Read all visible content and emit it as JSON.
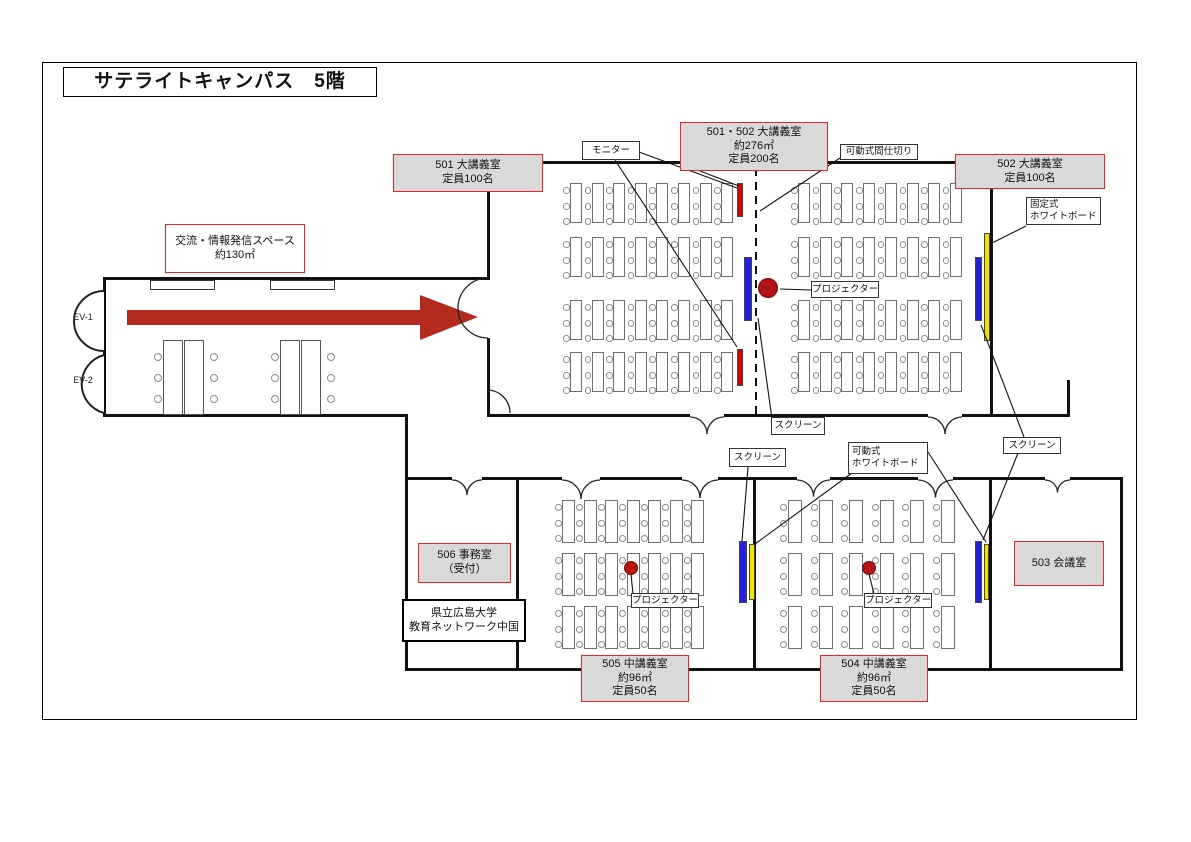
{
  "floorplan": {
    "colors": {
      "wall": "#111111",
      "label_red_border": "#f02121",
      "label_gray_fill": "#d9d9d9",
      "monitor": "#dd0000",
      "screen": "#2020dd",
      "whiteboard": "#f2e200",
      "projector": "#b41414",
      "arrow": "#b22b1e"
    },
    "frame": {
      "x": 42,
      "y": 62,
      "w": 1095,
      "h": 658
    },
    "labels": [
      {
        "name": "page-title",
        "type": "t-title",
        "x": 63,
        "y": 67,
        "w": 314,
        "h": 30,
        "lines": [
          "サテライトキャンパス　5階"
        ]
      },
      {
        "name": "room-label-501-502",
        "type": "t-room",
        "x": 680,
        "y": 122,
        "w": 148,
        "h": 49,
        "lines": [
          "501・502 大講義室",
          "約276㎡",
          "定員200名"
        ]
      },
      {
        "name": "room-label-501",
        "type": "t-room",
        "x": 393,
        "y": 154,
        "w": 150,
        "h": 38,
        "lines": [
          "501 大講義室",
          "定員100名"
        ]
      },
      {
        "name": "room-label-502",
        "type": "t-room",
        "x": 955,
        "y": 154,
        "w": 150,
        "h": 35,
        "lines": [
          "502 大講義室",
          "定員100名"
        ]
      },
      {
        "name": "open-space-label",
        "type": "t-open",
        "x": 165,
        "y": 224,
        "w": 140,
        "h": 49,
        "lines": [
          "交流・情報発信スペース",
          "約130㎡"
        ]
      },
      {
        "name": "room-label-503",
        "type": "t-room",
        "x": 1014,
        "y": 541,
        "w": 90,
        "h": 45,
        "lines": [
          "503 会議室"
        ]
      },
      {
        "name": "room-label-504",
        "type": "t-room",
        "x": 820,
        "y": 655,
        "w": 108,
        "h": 47,
        "lines": [
          "504 中講義室",
          "約96㎡",
          "定員50名"
        ]
      },
      {
        "name": "room-label-505",
        "type": "t-room",
        "x": 581,
        "y": 655,
        "w": 108,
        "h": 47,
        "lines": [
          "505 中講義室",
          "約96㎡",
          "定員50名"
        ]
      },
      {
        "name": "room-label-506",
        "type": "t-room",
        "x": 418,
        "y": 543,
        "w": 93,
        "h": 40,
        "lines": [
          "506 事務室",
          "（受付）"
        ]
      },
      {
        "name": "org-label",
        "type": "t-info",
        "x": 402,
        "y": 599,
        "w": 124,
        "h": 43,
        "lines": [
          "県立広島大学",
          "教育ネットワーク中国"
        ]
      },
      {
        "name": "tag-monitor",
        "type": "t-tag",
        "x": 582,
        "y": 141,
        "w": 58,
        "h": 19,
        "lines": [
          "モニター"
        ]
      },
      {
        "name": "tag-movable-partition",
        "type": "t-tag",
        "x": 840,
        "y": 144,
        "w": 78,
        "h": 16,
        "lines": [
          "可動式間仕切り"
        ]
      },
      {
        "name": "tag-fixed-whiteboard",
        "type": "t-tagL",
        "x": 1026,
        "y": 197,
        "w": 75,
        "h": 28,
        "lines": [
          "固定式",
          "ホワイトボード"
        ]
      },
      {
        "name": "tag-projector-main",
        "type": "t-tag",
        "x": 811,
        "y": 281,
        "w": 68,
        "h": 17,
        "lines": [
          "プロジェクター"
        ]
      },
      {
        "name": "tag-screen-main",
        "type": "t-tag",
        "x": 771,
        "y": 417,
        "w": 54,
        "h": 18,
        "lines": [
          "スクリーン"
        ]
      },
      {
        "name": "tag-screen-505",
        "type": "t-tag",
        "x": 729,
        "y": 448,
        "w": 57,
        "h": 19,
        "lines": [
          "スクリーン"
        ]
      },
      {
        "name": "tag-movable-whiteboard",
        "type": "t-tagL",
        "x": 848,
        "y": 442,
        "w": 80,
        "h": 32,
        "lines": [
          "可動式",
          "ホワイトボード"
        ]
      },
      {
        "name": "tag-screen-right",
        "type": "t-tag",
        "x": 1003,
        "y": 437,
        "w": 58,
        "h": 17,
        "lines": [
          "スクリーン"
        ]
      },
      {
        "name": "tag-projector-505",
        "type": "t-tag",
        "x": 631,
        "y": 593,
        "w": 68,
        "h": 15,
        "lines": [
          "プロジェクター"
        ]
      },
      {
        "name": "tag-projector-504",
        "type": "t-tag",
        "x": 864,
        "y": 593,
        "w": 68,
        "h": 15,
        "lines": [
          "プロジェクター"
        ]
      },
      {
        "name": "ev1-label",
        "type": "t-plain",
        "x": 66,
        "y": 312,
        "w": 34,
        "h": 12,
        "lines": [
          "EV-1"
        ]
      },
      {
        "name": "ev2-label",
        "type": "t-plain",
        "x": 66,
        "y": 375,
        "w": 34,
        "h": 12,
        "lines": [
          "EV-2"
        ]
      }
    ],
    "walls": [
      [
        487,
        161,
        509,
        3
      ],
      [
        487,
        161,
        3,
        117
      ],
      [
        487,
        338,
        3,
        79
      ],
      [
        990,
        164,
        3,
        253
      ],
      [
        487,
        414,
        203,
        3
      ],
      [
        724,
        414,
        204,
        3
      ],
      [
        962,
        414,
        108,
        3
      ],
      [
        1067,
        380,
        3,
        37
      ],
      [
        103,
        277,
        387,
        3
      ],
      [
        103,
        277,
        3,
        140
      ],
      [
        103,
        414,
        305,
        3
      ],
      [
        405,
        414,
        3,
        66
      ],
      [
        405,
        477,
        47,
        3
      ],
      [
        482,
        477,
        80,
        3
      ],
      [
        600,
        477,
        82,
        3
      ],
      [
        718,
        477,
        79,
        3
      ],
      [
        830,
        477,
        88,
        3
      ],
      [
        953,
        477,
        92,
        3
      ],
      [
        1070,
        477,
        53,
        3
      ],
      [
        405,
        477,
        3,
        194
      ],
      [
        516,
        477,
        3,
        194
      ],
      [
        753,
        477,
        3,
        194
      ],
      [
        989,
        477,
        3,
        194
      ],
      [
        1120,
        477,
        3,
        194
      ],
      [
        405,
        668,
        718,
        3
      ]
    ],
    "dashed_partitions": [
      {
        "name": "movable-partition-line",
        "x": 754.5,
        "y": 168,
        "w": 2.5,
        "h": 246
      }
    ],
    "doors_south": [
      {
        "x1": 690,
        "x2": 724,
        "y": 417
      },
      {
        "x1": 928,
        "x2": 962,
        "y": 417
      },
      {
        "x1": 452,
        "x2": 482,
        "y": 480
      },
      {
        "x1": 562,
        "x2": 600,
        "y": 480
      },
      {
        "x1": 682,
        "x2": 718,
        "y": 480
      },
      {
        "x1": 797,
        "x2": 830,
        "y": 480
      },
      {
        "x1": 918,
        "x2": 953,
        "y": 480
      },
      {
        "x1": 1045,
        "x2": 1070,
        "y": 480
      }
    ],
    "doors_west": [
      {
        "x": 488,
        "y1": 278,
        "y2": 338,
        "r": 30
      }
    ],
    "doors_raw": [
      {
        "d": "M 487,390 A 23 23 0 0 1 510,413"
      }
    ],
    "elevators": [
      {
        "name": "elevator-ev1",
        "d": "M 104,291 A 30 30 0 0 0 104,351"
      },
      {
        "name": "elevator-ev2",
        "d": "M 104,355 A 30 30 0 0 0 104,413"
      }
    ],
    "arrow": {
      "points": "127,310 420,310 420,295 478,317 420,340 420,325 127,325"
    },
    "pointer_lines": [
      [
        639,
        152,
        737,
        188
      ],
      [
        615,
        160,
        737,
        347
      ],
      [
        700,
        171,
        739,
        186
      ],
      [
        843,
        156,
        760,
        211
      ],
      [
        811,
        290,
        780,
        289
      ],
      [
        772,
        419,
        758,
        318
      ],
      [
        1026,
        226,
        992,
        243
      ],
      [
        748,
        467,
        742,
        541
      ],
      [
        852,
        473,
        755,
        544
      ],
      [
        928,
        452,
        986,
        542
      ],
      [
        1024,
        437,
        981,
        325
      ],
      [
        1018,
        453,
        983,
        540
      ],
      [
        631,
        574,
        633,
        594
      ],
      [
        869,
        574,
        874,
        594
      ]
    ],
    "desk_groups": [
      {
        "room": "501",
        "x": 570,
        "dx": 21.6,
        "cols": 8,
        "bandYs": [
          183,
          237,
          300,
          352
        ],
        "deskW": 12,
        "deskH": 40,
        "chairXoff": -7,
        "chairYoffs": [
          4,
          20,
          35
        ],
        "chairD": 6.5
      },
      {
        "room": "502",
        "x": 798,
        "dx": 21.7,
        "cols": 8,
        "bandYs": [
          183,
          237,
          300,
          352
        ],
        "deskW": 12,
        "deskH": 40,
        "chairXoff": -7,
        "chairYoffs": [
          4,
          20,
          35
        ],
        "chairD": 6.5
      },
      {
        "room": "505",
        "x": 562,
        "dx": 21.5,
        "cols": 7,
        "bandYs": [
          500,
          553,
          606
        ],
        "deskW": 13,
        "deskH": 43,
        "chairXoff": -7.5,
        "chairYoffs": [
          4,
          20,
          35
        ],
        "chairD": 7
      },
      {
        "room": "504",
        "x": 788,
        "dx": 30.5,
        "cols": 6,
        "bandYs": [
          500,
          553,
          606
        ],
        "deskW": 14,
        "deskH": 43,
        "chairXoff": -8,
        "chairYoffs": [
          4,
          20,
          35
        ],
        "chairD": 7
      }
    ],
    "lobby": {
      "tableW": 20,
      "tableH": 75,
      "tables": [
        [
          163,
          340
        ],
        [
          184,
          340
        ],
        [
          280,
          340
        ],
        [
          301,
          340
        ]
      ],
      "chairD": 8,
      "chairs": [
        [
          154,
          353
        ],
        [
          154,
          374
        ],
        [
          154,
          395
        ],
        [
          210,
          353
        ],
        [
          210,
          374
        ],
        [
          210,
          395
        ],
        [
          271,
          353
        ],
        [
          271,
          374
        ],
        [
          271,
          395
        ],
        [
          327,
          353
        ],
        [
          327,
          374
        ],
        [
          327,
          395
        ]
      ],
      "counters": [
        [
          150,
          280,
          65,
          10
        ],
        [
          270,
          280,
          65,
          10
        ]
      ]
    },
    "equipment": [
      {
        "name": "monitor-bar-top",
        "color": "monitor",
        "x": 737,
        "y": 183,
        "w": 6,
        "h": 34
      },
      {
        "name": "monitor-bar-bottom",
        "color": "monitor",
        "x": 737,
        "y": 349,
        "w": 6,
        "h": 37
      },
      {
        "name": "screen-bar-center",
        "color": "screen",
        "x": 744,
        "y": 257,
        "w": 8,
        "h": 64
      },
      {
        "name": "screen-bar-502-right",
        "color": "screen",
        "x": 975,
        "y": 257,
        "w": 7,
        "h": 64
      },
      {
        "name": "whiteboard-bar-fixed",
        "color": "whiteboard",
        "x": 984,
        "y": 233,
        "w": 6,
        "h": 108
      },
      {
        "name": "screen-bar-505",
        "color": "screen",
        "x": 739,
        "y": 541,
        "w": 8,
        "h": 62
      },
      {
        "name": "whiteboard-bar-505",
        "color": "whiteboard",
        "x": 749,
        "y": 544,
        "w": 6,
        "h": 56
      },
      {
        "name": "screen-bar-504-right",
        "color": "screen",
        "x": 975,
        "y": 541,
        "w": 7,
        "h": 62
      },
      {
        "name": "whiteboard-bar-504",
        "color": "whiteboard",
        "x": 984,
        "y": 544,
        "w": 5,
        "h": 56
      }
    ],
    "projectors": [
      {
        "name": "projector-dot-main",
        "cx": 768,
        "cy": 288,
        "r": 10
      },
      {
        "name": "projector-dot-505",
        "cx": 631,
        "cy": 568,
        "r": 7
      },
      {
        "name": "projector-dot-504",
        "cx": 869,
        "cy": 568,
        "r": 7
      }
    ]
  }
}
